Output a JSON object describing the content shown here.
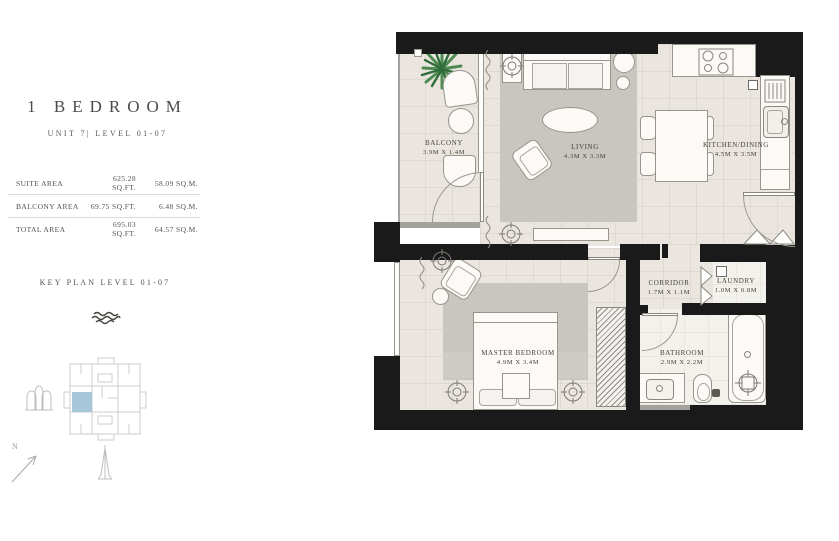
{
  "panel": {
    "title": "1 BEDROOM",
    "subtitle": "UNIT 7| LEVEL 01-07",
    "area_table": {
      "rows": [
        {
          "label": "SUITE AREA",
          "sqft": "625.28 SQ.FT.",
          "sqm": "58.09 SQ.M."
        },
        {
          "label": "BALCONY AREA",
          "sqft": "69.75 SQ.FT.",
          "sqm": "6.48 SQ.M."
        },
        {
          "label": "TOTAL AREA",
          "sqft": "695.03 SQ.FT.",
          "sqm": "64.57 SQ.M."
        }
      ]
    },
    "keyplan_title": "KEY PLAN LEVEL 01-07",
    "north_label": "N"
  },
  "plan": {
    "rooms": {
      "balcony": {
        "name": "BALCONY",
        "dims": "3.9M X 1.4M"
      },
      "living": {
        "name": "LIVING",
        "dims": "4.3M X 3.3M"
      },
      "kitchen": {
        "name": "KITCHEN/DINING",
        "dims": "4.5M X 3.5M"
      },
      "master": {
        "name": "MASTER BEDROOM",
        "dims": "4.9M X 3.4M"
      },
      "corridor": {
        "name": "CORRIDOR",
        "dims": "1.7M X 1.1M"
      },
      "laundry": {
        "name": "LAUNDRY",
        "dims": "1.0M X 0.8M"
      },
      "bathroom": {
        "name": "BATHROOM",
        "dims": "2.9M X 2.2M"
      }
    },
    "icons": {
      "wave": "wave-icon",
      "arch_building": "arch-building-icon",
      "spire": "spire-tower-icon",
      "north_arrow": "north-arrow-icon",
      "plant": "plant-icon"
    }
  },
  "colors": {
    "wall": "#1a1a1a",
    "floor": "#eae6df",
    "rug": "#c9c6c0",
    "keyplan_highlight": "#a7c6d9",
    "plant_green": "#4e8b51",
    "text_dark": "#4b4a46"
  }
}
